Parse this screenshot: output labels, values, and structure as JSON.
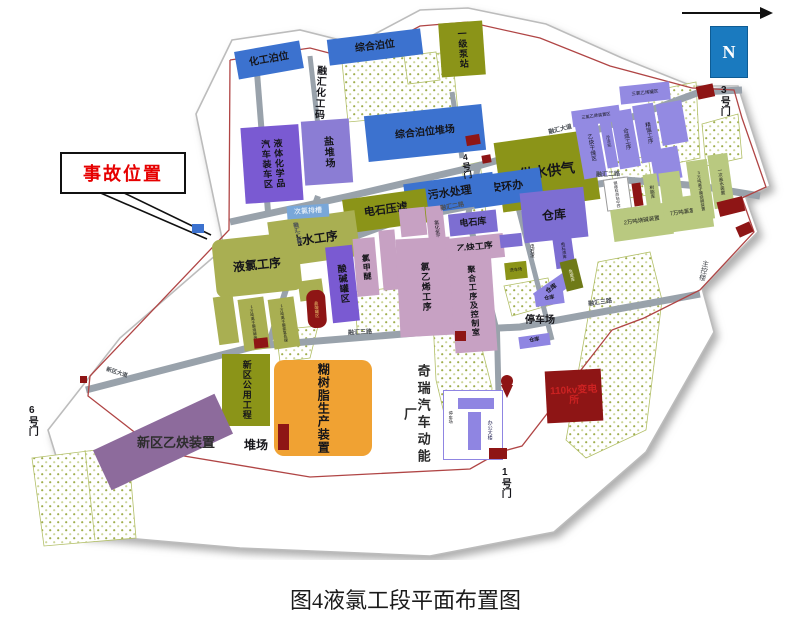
{
  "caption": "图4液氯工段平面布置图",
  "compass": {
    "n": "N"
  },
  "callout": {
    "text": "事故位置"
  },
  "gates": {
    "g1": "1号门",
    "g3": "3号门",
    "g4": "4号门",
    "g6": "6号门"
  },
  "roads": {
    "avenue": "融汇大道",
    "second": "融汇二路",
    "third": "融汇三路",
    "xinqu": "新区大道"
  },
  "labels": {
    "huagong_bowei": "化工泊位",
    "zonghe_bowei": "综合泊位",
    "ronghui_wharf": "融汇化工码头",
    "zonghe_duichang": "综合泊位堆场",
    "yan_duichang": "盐堆场",
    "qiche_zhuangche": "汽车装车区",
    "yeti_huaxuepin": "液体化学品",
    "yiji_bengzhan": "一级泵站",
    "gongshui_gongqi": "供水供气",
    "anhuanban": "安环办",
    "wushui_chuli": "污水处理",
    "dianshi_yalv": "电石压滤",
    "yanshui_gongxu": "盐水工序",
    "yelv_gongxu": "液氯工序",
    "cilv_pt": "次氯排槽",
    "limo_1w_a": "1万吨离子膜烧碱装置",
    "limo_1w_b": "1万吨离子膜氯氢处理",
    "yansuan_guanqu": "盐酸罐区",
    "suanjian_guanqu": "酸碱罐区",
    "lvjiami": "氯甲醚",
    "lvhuaqing_gongxu": "氯化氢工序",
    "lvyixi_gongxu": "氯乙烯工序",
    "dianshiku": "电石库",
    "yique_gongxu": "乙炔工序",
    "juhe_gongxu": "聚合工序及控制室",
    "cangku": "仓库",
    "dianshizha": "电石渣",
    "xichechang": "洗车场",
    "dianshizha_ku": "电石渣库",
    "weifeiku": "危废库",
    "tingchechang": "停车场",
    "bian_110": "110kv变电所",
    "bangong_dalou": "办公大楼",
    "qirui": "奇瑞汽车动能厂",
    "zhukonglou": "主控楼",
    "xinqu_gongyong": "新区公用工程",
    "hushuzhi": "糊树脂生产装置",
    "duichang": "堆场",
    "xinqu_yique": "新区乙炔装置",
    "yique_ganzao": "乙炔干燥区",
    "lengdongzhan": "冷冻站",
    "hecheng_gongxu": "合成工序",
    "jingliu_gongxu": "精馏工序",
    "sanlv_guanqu": "三氯乙烯罐区",
    "sanlv_zhuangzhi": "三氯乙烯装置区",
    "gangping": "钢瓶检测站中控",
    "shuzhiku": "树脂库",
    "shaojian_2w": "2万吨烧碱装置",
    "lvqing_7w": "7万吨氯氢处理",
    "shaojian_3w": "3万吨离子膜烧碱装置",
    "yici_yanshui": "一次盐水装置"
  },
  "colors": {
    "accident_red": "#e60000",
    "blue_building": "#3c72cf",
    "olive_dark": "#8b9418",
    "olive_light": "#a9af52",
    "green_light": "#b9c980",
    "violet": "#7a5ad2",
    "purple": "#8b7dd4",
    "lavender": "#938ae2",
    "mauve_pink": "#c7a1c3",
    "orange": "#f0a233",
    "dark_red": "#8e1515",
    "compass_blue": "#1a7abf",
    "road_gray": "#99a2ab",
    "fence_red": "#b04545"
  }
}
